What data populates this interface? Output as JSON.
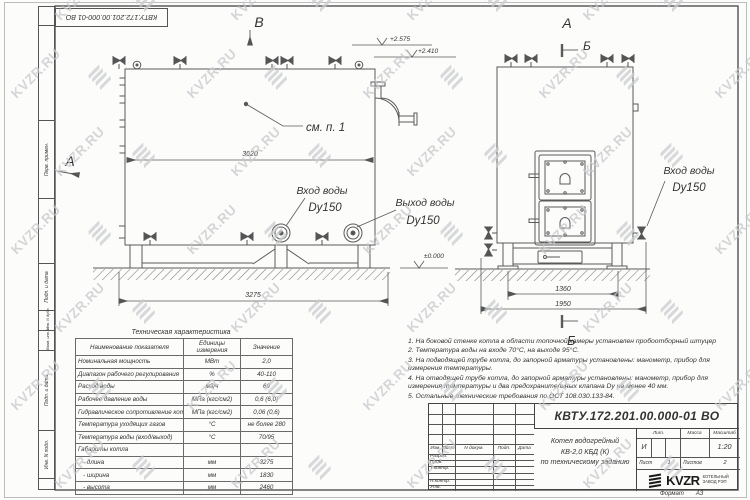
{
  "page": {
    "bg": "#fcfcfb",
    "line_color": "#555555",
    "frame_color": "#444444",
    "watermark_color": "#c6c9cc"
  },
  "doc": {
    "stamp_number": "КВТУ.172.201.00.000-01 ВО",
    "format_label": "Формат",
    "format_value": "А3"
  },
  "watermark": {
    "text": "KVZR.RU"
  },
  "margin_stamps": {
    "s1": "Перв. примен.",
    "s2": "Подп. и дата",
    "s3": "Инв. N дубл.",
    "s4": "Взам. инв. N",
    "s5": "Подп. и дата",
    "s6": "Инв. N подл."
  },
  "views": {
    "front": {
      "view_label": "В",
      "arrow_label": "А",
      "elev_top": "+2.575",
      "elev_mid": "+2.410",
      "elev_zero": "±0.000",
      "see_note": "см. п. 1",
      "dim_length": "3020",
      "dim_base": "3275",
      "inlet_caption": "Вход воды",
      "inlet_dn": "Dy150",
      "outlet_caption": "Выход воды",
      "outlet_dn": "Dy150"
    },
    "side": {
      "view_label": "А",
      "section_top": "Б",
      "section_bottom": "Б",
      "dim_supports": "1360",
      "dim_overall": "1950",
      "inlet_caption": "Вход воды",
      "inlet_dn": "Dy150"
    }
  },
  "spec_table": {
    "title": "Техническая характеристика",
    "headers": [
      "Наименование показателя",
      "Единицы измерения",
      "Значение"
    ],
    "rows": [
      [
        "Номинальная мощность",
        "МВт",
        "2,0"
      ],
      [
        "Диапазон рабочего регулирования",
        "%",
        "40-110"
      ],
      [
        "Расход воды",
        "м3/ч",
        "69"
      ],
      [
        "Рабочее давление воды",
        "МПа (кгс/см2)",
        "0,6 (6,0)"
      ],
      [
        "Гидравлическое сопротивление котла",
        "МПа (кгс/см2)",
        "0,06 (0,6)"
      ],
      [
        "Температура уходящих газов",
        "°С",
        "не более 280"
      ],
      [
        "Температура воды (вход/выход)",
        "°С",
        "70/95"
      ],
      [
        "Габариты котла",
        "",
        ""
      ],
      [
        "   - длина",
        "мм",
        "3275"
      ],
      [
        "   - ширина",
        "мм",
        "1830"
      ],
      [
        "   - высота",
        "мм",
        "2460"
      ]
    ]
  },
  "notes": {
    "items": [
      "1. На боковой стенке котла в области топочной камеры установлен пробоотборный штуцер",
      "2. Температура воды на входе 70°С, на выходе 95°С.",
      "3. На подводящей трубе котла, до запорной арматуры установлены: манометр, прибор для измерения температуры.",
      "4. На отводящей трубе котла, до запорной арматуры установлены: манометр, прибор для измерения температуры и два предохранительных клапана Dу не менее 40 мм.",
      "5. Остальные технические требования по ОСТ 108.030.133-84."
    ]
  },
  "title_block": {
    "doc_number": "КВТУ.172.201.00.000-01 ВО",
    "name_line1": "Котел водогрейный",
    "name_line2": "КВ-2,0 КБД (К)",
    "name_line3": "по техническому заданию",
    "cols": [
      "Изм.",
      "Лист",
      "N докум.",
      "Подп.",
      "Дата"
    ],
    "sign_rows": [
      "Разраб.",
      "Пров.",
      "Т.контр.",
      "",
      "Н.контр.",
      "Утв."
    ],
    "lit_label": "Лит.",
    "lit_value": "И",
    "mass_label": "Масса",
    "scale_label": "Масштаб",
    "scale_value": "1:20",
    "sheet_label": "Лист",
    "sheet_value": "1",
    "sheets_label": "Листов",
    "sheets_value": "2",
    "company_name": "KVZR",
    "company_line1": "КОТЕЛЬНЫЙ",
    "company_line2": "ЗАВОД РЭП"
  }
}
